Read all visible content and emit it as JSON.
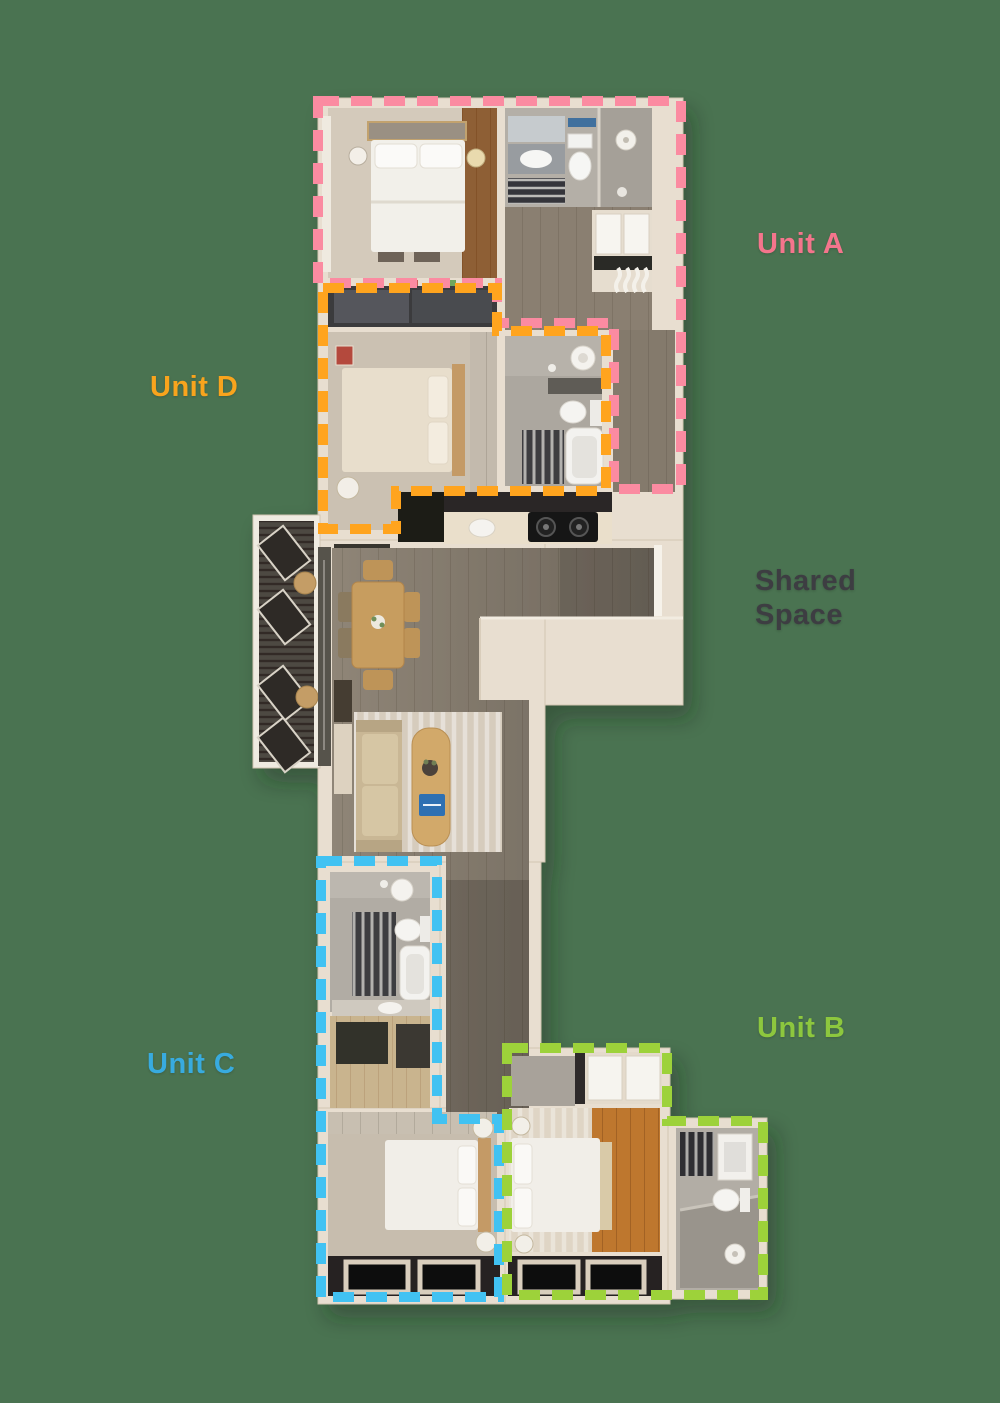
{
  "background_color": "#4A7351",
  "labels": {
    "unit_a": {
      "text": "Unit A",
      "color": "#F4758C"
    },
    "unit_d": {
      "text": "Unit D",
      "color": "#F8A41D"
    },
    "shared_space": {
      "line1": "Shared",
      "line2": "Space",
      "color": "#3D3D42"
    },
    "unit_c": {
      "text": "Unit C",
      "color": "#38ABDF"
    },
    "unit_b": {
      "text": "Unit B",
      "color": "#8DC73E"
    }
  },
  "outlines": {
    "unit_a": {
      "label": "Unit A",
      "color": "#FB8BA1"
    },
    "unit_d": {
      "label": "Unit D",
      "color": "#FFA41E"
    },
    "unit_c": {
      "label": "Unit C",
      "color": "#41C2F2"
    },
    "unit_b": {
      "label": "Unit B",
      "color": "#9DD23A"
    }
  }
}
